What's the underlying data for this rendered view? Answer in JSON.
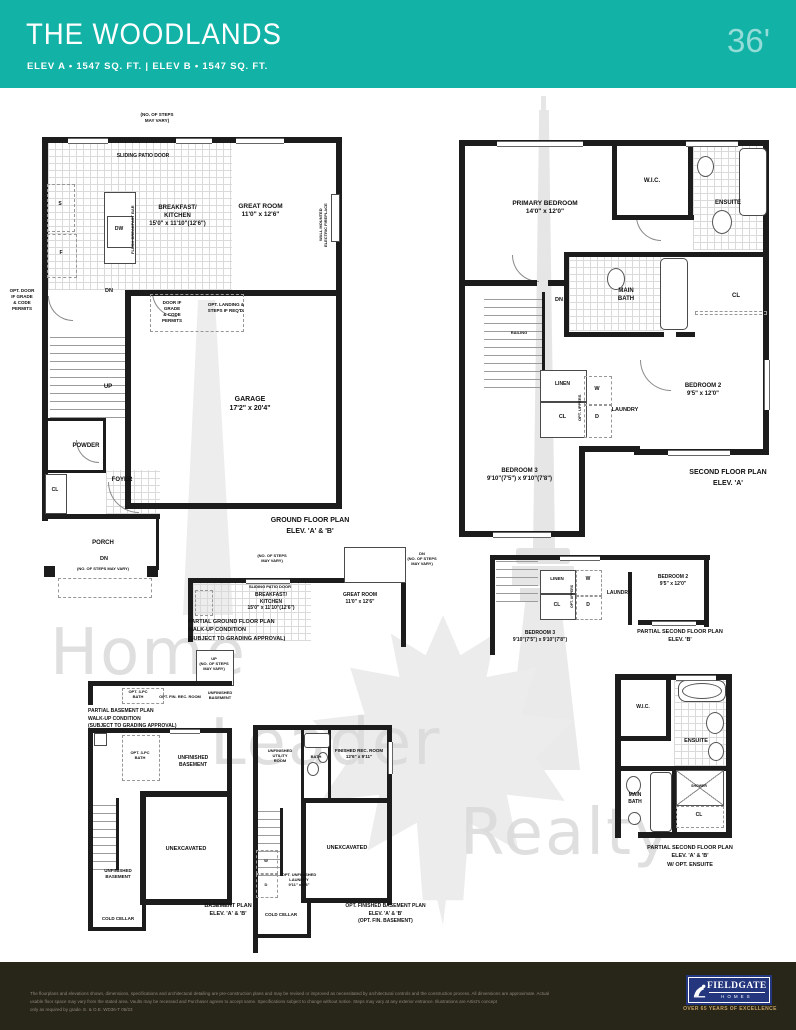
{
  "header": {
    "title": "THE WOODLANDS",
    "subtitle": "ELEV A  • 1547 SQ. FT.  |  ELEV B  • 1547 SQ. FT.",
    "frontage": "36'"
  },
  "common": {
    "dn": "DN",
    "up": "UP",
    "cl": "CL",
    "s": "S",
    "f": "F",
    "dw": "DW",
    "w": "W",
    "d": "D",
    "linen": "LINEN",
    "laundry": "LAUNDRY",
    "railing": "RAILING",
    "opt_uppers": "OPT. UPPERS",
    "steps1": "(NO. OF STEPS MAY VARY)",
    "steps2": "(NO. OF STEPS\nMAY VARY)",
    "dn_steps3": "DN\n(NO. OF STEPS\nMAY VARY)",
    "sliding_patio_door": "SLIDING PATIO DOOR",
    "cold_cellar": "COLD CELLAR",
    "unexcavated": "UNEXCAVATED",
    "unfinished_basement": "UNFINISHED\nBASEMENT",
    "bedroom2": "BEDROOM 2\n9'5\" x 12'0\"",
    "bedroom3": "BEDROOM 3\n9'10\"(7'5\") x 9'10\"(7'8\")",
    "breakfast_kitchen": "BREAKFAST/\nKITCHEN\n15'0\" x 11'10\"(12'6\")",
    "great_room": "GREAT ROOM\n11'0\" x 12'6\"",
    "wic": "W.I.C.",
    "ensuite": "ENSUITE",
    "main_bath": "MAIN\nBATH",
    "shower": "SHOWER"
  },
  "ground": {
    "caption": "GROUND FLOOR PLAN\nELEV. 'A' & 'B'",
    "garage": "GARAGE\n17'2\" x 20'4\"",
    "powder": "POWDER",
    "foyer": "FOYER",
    "porch": "PORCH",
    "flush_bar": "FLUSH BREAKFAST BAR",
    "fireplace": "WALL MOUNTED\nELECTRIC FIREPLACE",
    "opt_door": "OPT. DOOR\nIF GRADE\n& CODE\nPERMITS",
    "door_if": "DOOR IF\nGRADE\n& CODE\nPERMITS",
    "opt_landing": "OPT. LANDING &\nSTEPS IF REQ'D."
  },
  "second": {
    "caption": "SECOND FLOOR PLAN\nELEV. 'A'",
    "primary": "PRIMARY BEDROOM\n14'0\" x 12'0\""
  },
  "partial_ground": {
    "caption": "PARTIAL GROUND FLOOR PLAN\nWALK-UP CONDITION\n(SUBJECT TO GRADING APPROVAL)"
  },
  "partial_second_b": {
    "caption": "PARTIAL SECOND FLOOR PLAN\nELEV. 'B'"
  },
  "basement": {
    "caption": "BASEMENT PLAN\nELEV. 'A' & 'B'",
    "partial_caption": "PARTIAL BASEMENT PLAN\nWALK-UP CONDITION\n(SUBJECT TO GRADING APPROVAL)",
    "up_steps": "UP\n(NO. OF STEPS\nMAY VARY)",
    "opt_bath": "OPT. 3-PC\nBATH",
    "opt_rec": "OPT. FIN. REC. ROOM"
  },
  "opt_basement": {
    "caption": "OPT. FINISHED BASEMENT PLAN\nELEV. 'A' & 'B'\n(OPT. FIN. BASEMENT)",
    "utility": "UNFINISHED\nUTILITY\nROOM",
    "bath": "BATH",
    "rec": "FINISHED REC. ROOM\n12'6\" x 9'11\"",
    "opt_laundry": "OPT. UNFINISHED\nLAUNDRY\n9'11\" x 8'8\""
  },
  "partial_ensuite": {
    "caption": "PARTIAL SECOND FLOOR PLAN\nELEV. 'A' & 'B'\nW/ OPT. ENSUITE"
  },
  "watermark": {
    "l1": "Home",
    "l2": "Leader",
    "l3": "Realty"
  },
  "footer": {
    "disclaimer": "The floorplans and elevations shown, dimensions, specifications and architectural detailing are pre-construction plans and may be revised or improved as necessitated by architectural controls and the construction process. All dimensions are approximate. Actual\nusable floor space may vary from the stated area. Vaults may be recessed and Purchaser agrees to accept same. Specifications subject to change without notice. Steps may vary at any exterior entrance. Illustrations are Artist's concept\nonly as required by grade. E. & O.E.   WD36-T   05/23",
    "logo_name": "FIELDGATE",
    "logo_sub": "HOMES",
    "tagline": "OVER 65 YEARS OF EXCELLENCE"
  }
}
